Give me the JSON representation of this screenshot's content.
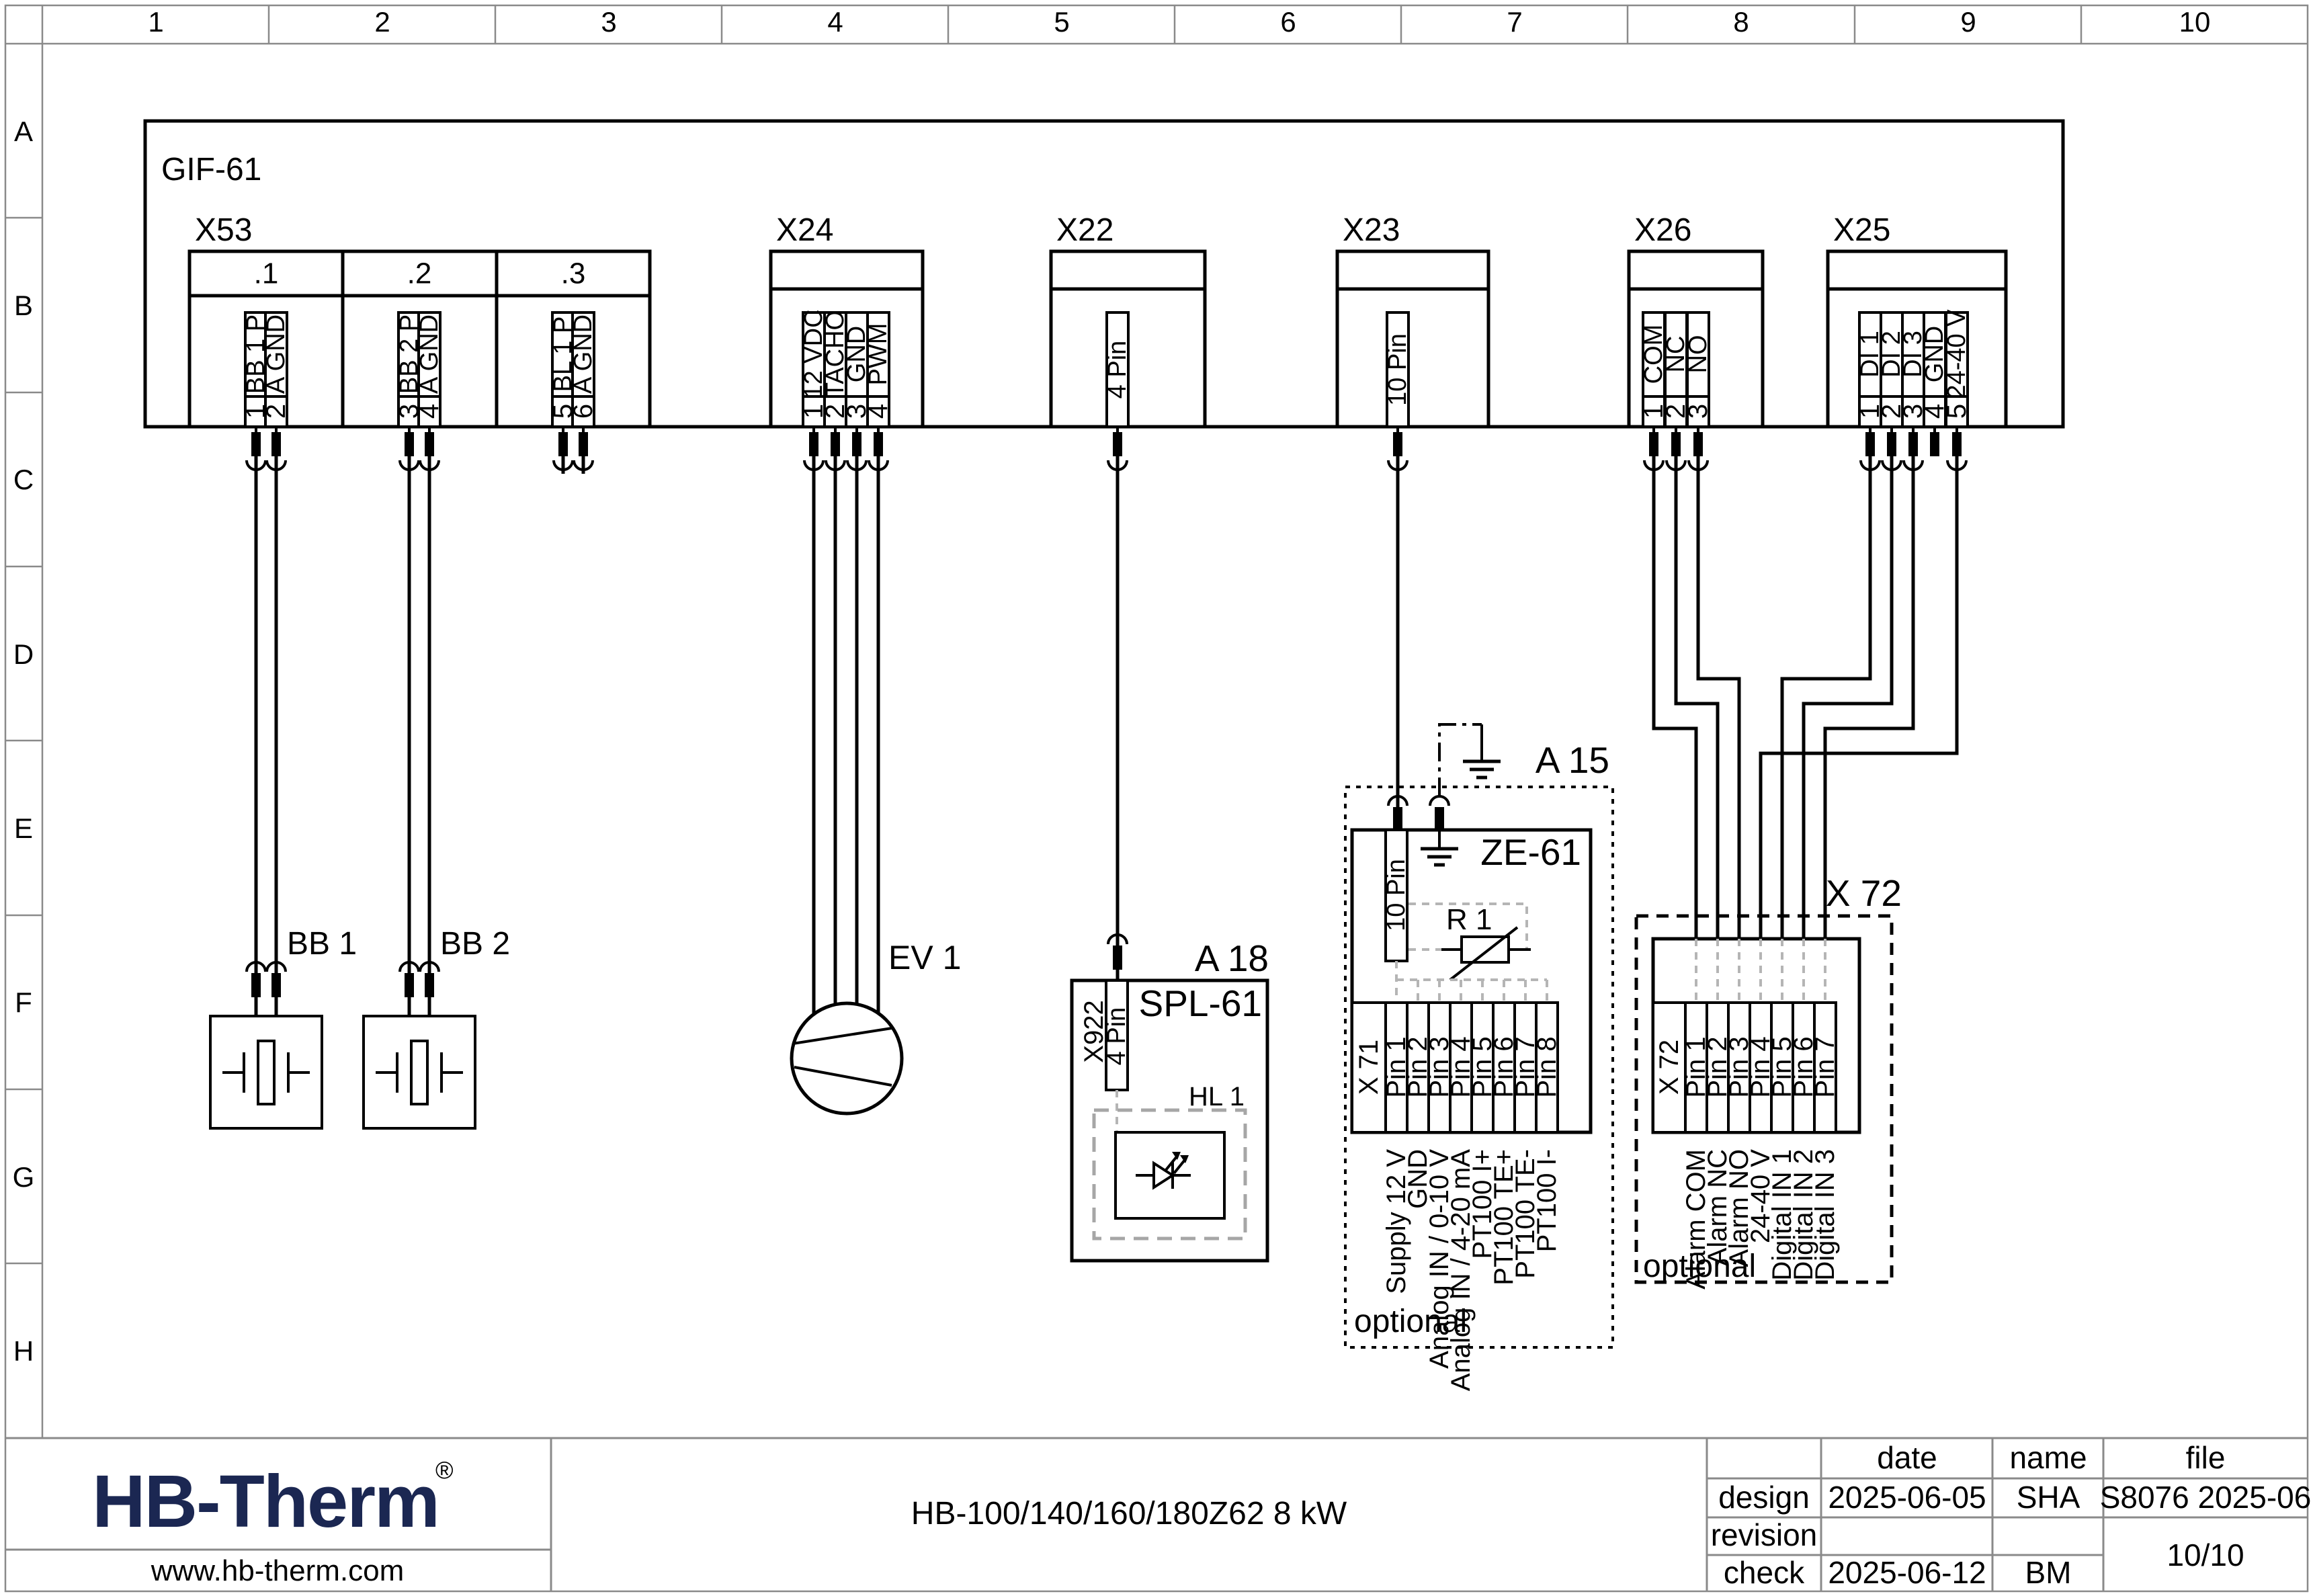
{
  "grid": {
    "cols": [
      "1",
      "2",
      "3",
      "4",
      "5",
      "6",
      "7",
      "8",
      "9",
      "10"
    ],
    "rows": [
      "A",
      "B",
      "C",
      "D",
      "E",
      "F",
      "G",
      "H"
    ]
  },
  "gif": {
    "label": "GIF-61"
  },
  "x53": {
    "label": "X53",
    "sections": [
      ".1",
      ".2",
      ".3"
    ],
    "pins": [
      {
        "n": "1",
        "s": "BB 1 P"
      },
      {
        "n": "2",
        "s": "A GND"
      },
      {
        "n": "3",
        "s": "BB 2 P"
      },
      {
        "n": "4",
        "s": "A GND"
      },
      {
        "n": "5",
        "s": "BL 1 P"
      },
      {
        "n": "6",
        "s": "A GND"
      }
    ]
  },
  "x24": {
    "label": "X24",
    "pins": [
      {
        "n": "1",
        "s": "12 VDC"
      },
      {
        "n": "2",
        "s": "TACHO"
      },
      {
        "n": "3",
        "s": "GND"
      },
      {
        "n": "4",
        "s": "PWM"
      }
    ]
  },
  "x22": {
    "label": "X22",
    "slot": "4 Pin"
  },
  "x23": {
    "label": "X23",
    "slot": "10 Pin"
  },
  "x26": {
    "label": "X26",
    "pins": [
      {
        "n": "1",
        "s": "COM"
      },
      {
        "n": "2",
        "s": "NC"
      },
      {
        "n": "3",
        "s": "NO"
      }
    ]
  },
  "x25": {
    "label": "X25",
    "pins": [
      {
        "n": "1",
        "s": "DI 1"
      },
      {
        "n": "2",
        "s": "DI 2"
      },
      {
        "n": "3",
        "s": "DI 3"
      },
      {
        "n": "4",
        "s": "GND"
      },
      {
        "n": "5",
        "s": "24-40 V"
      }
    ]
  },
  "bb1": {
    "label": "BB 1"
  },
  "bb2": {
    "label": "BB 2"
  },
  "ev1": {
    "label": "EV 1"
  },
  "a18": {
    "ref": "A 18",
    "name": "SPL-61",
    "conn": "X922",
    "slot": "4 Pin",
    "hl": "HL 1"
  },
  "a15": {
    "ref": "A 15",
    "name": "ZE-61",
    "slot": "10 Pin",
    "r1": "R 1",
    "optional": "optional",
    "x71": {
      "label": "X 71",
      "pins": [
        "Pin 1",
        "Pin 2",
        "Pin 3",
        "Pin 4",
        "Pin 5",
        "Pin 6",
        "Pin 7",
        "Pin 8"
      ],
      "signals": [
        "Supply 12 V",
        "GND",
        "Analog IN / 0-10 V",
        "Analog IN / 4-20 mA",
        "PT100 I+",
        "PT100 TE+",
        "PT100 TE-",
        "PT100 I-"
      ]
    }
  },
  "x72": {
    "ref": "X 72",
    "optional": "optional",
    "strip": {
      "label": "X 72",
      "pins": [
        "Pin 1",
        "Pin 2",
        "Pin 3",
        "Pin 4",
        "Pin 5",
        "Pin 6",
        "Pin 7"
      ],
      "signals": [
        "Alarm COM",
        "Alarm NC",
        "Alarm NO",
        "24-40 V",
        "Digital IN 1",
        "Digital IN 2",
        "Digital IN 3"
      ]
    }
  },
  "brand": {
    "logo": "HB-Therm",
    "reg": "®",
    "url": "www.hb-therm.com"
  },
  "doc": {
    "title": "HB-100/140/160/180Z62 8 kW"
  },
  "titleblock": {
    "headers": {
      "date": "date",
      "name": "name",
      "file": "file"
    },
    "design": {
      "label": "design",
      "date": "2025-06-05",
      "name": "SHA",
      "file": "S8076 2025-06"
    },
    "revision": {
      "label": "revision",
      "date": "",
      "name": ""
    },
    "check": {
      "label": "check",
      "date": "2025-06-12",
      "name": "BM"
    },
    "pages": "10/10"
  }
}
